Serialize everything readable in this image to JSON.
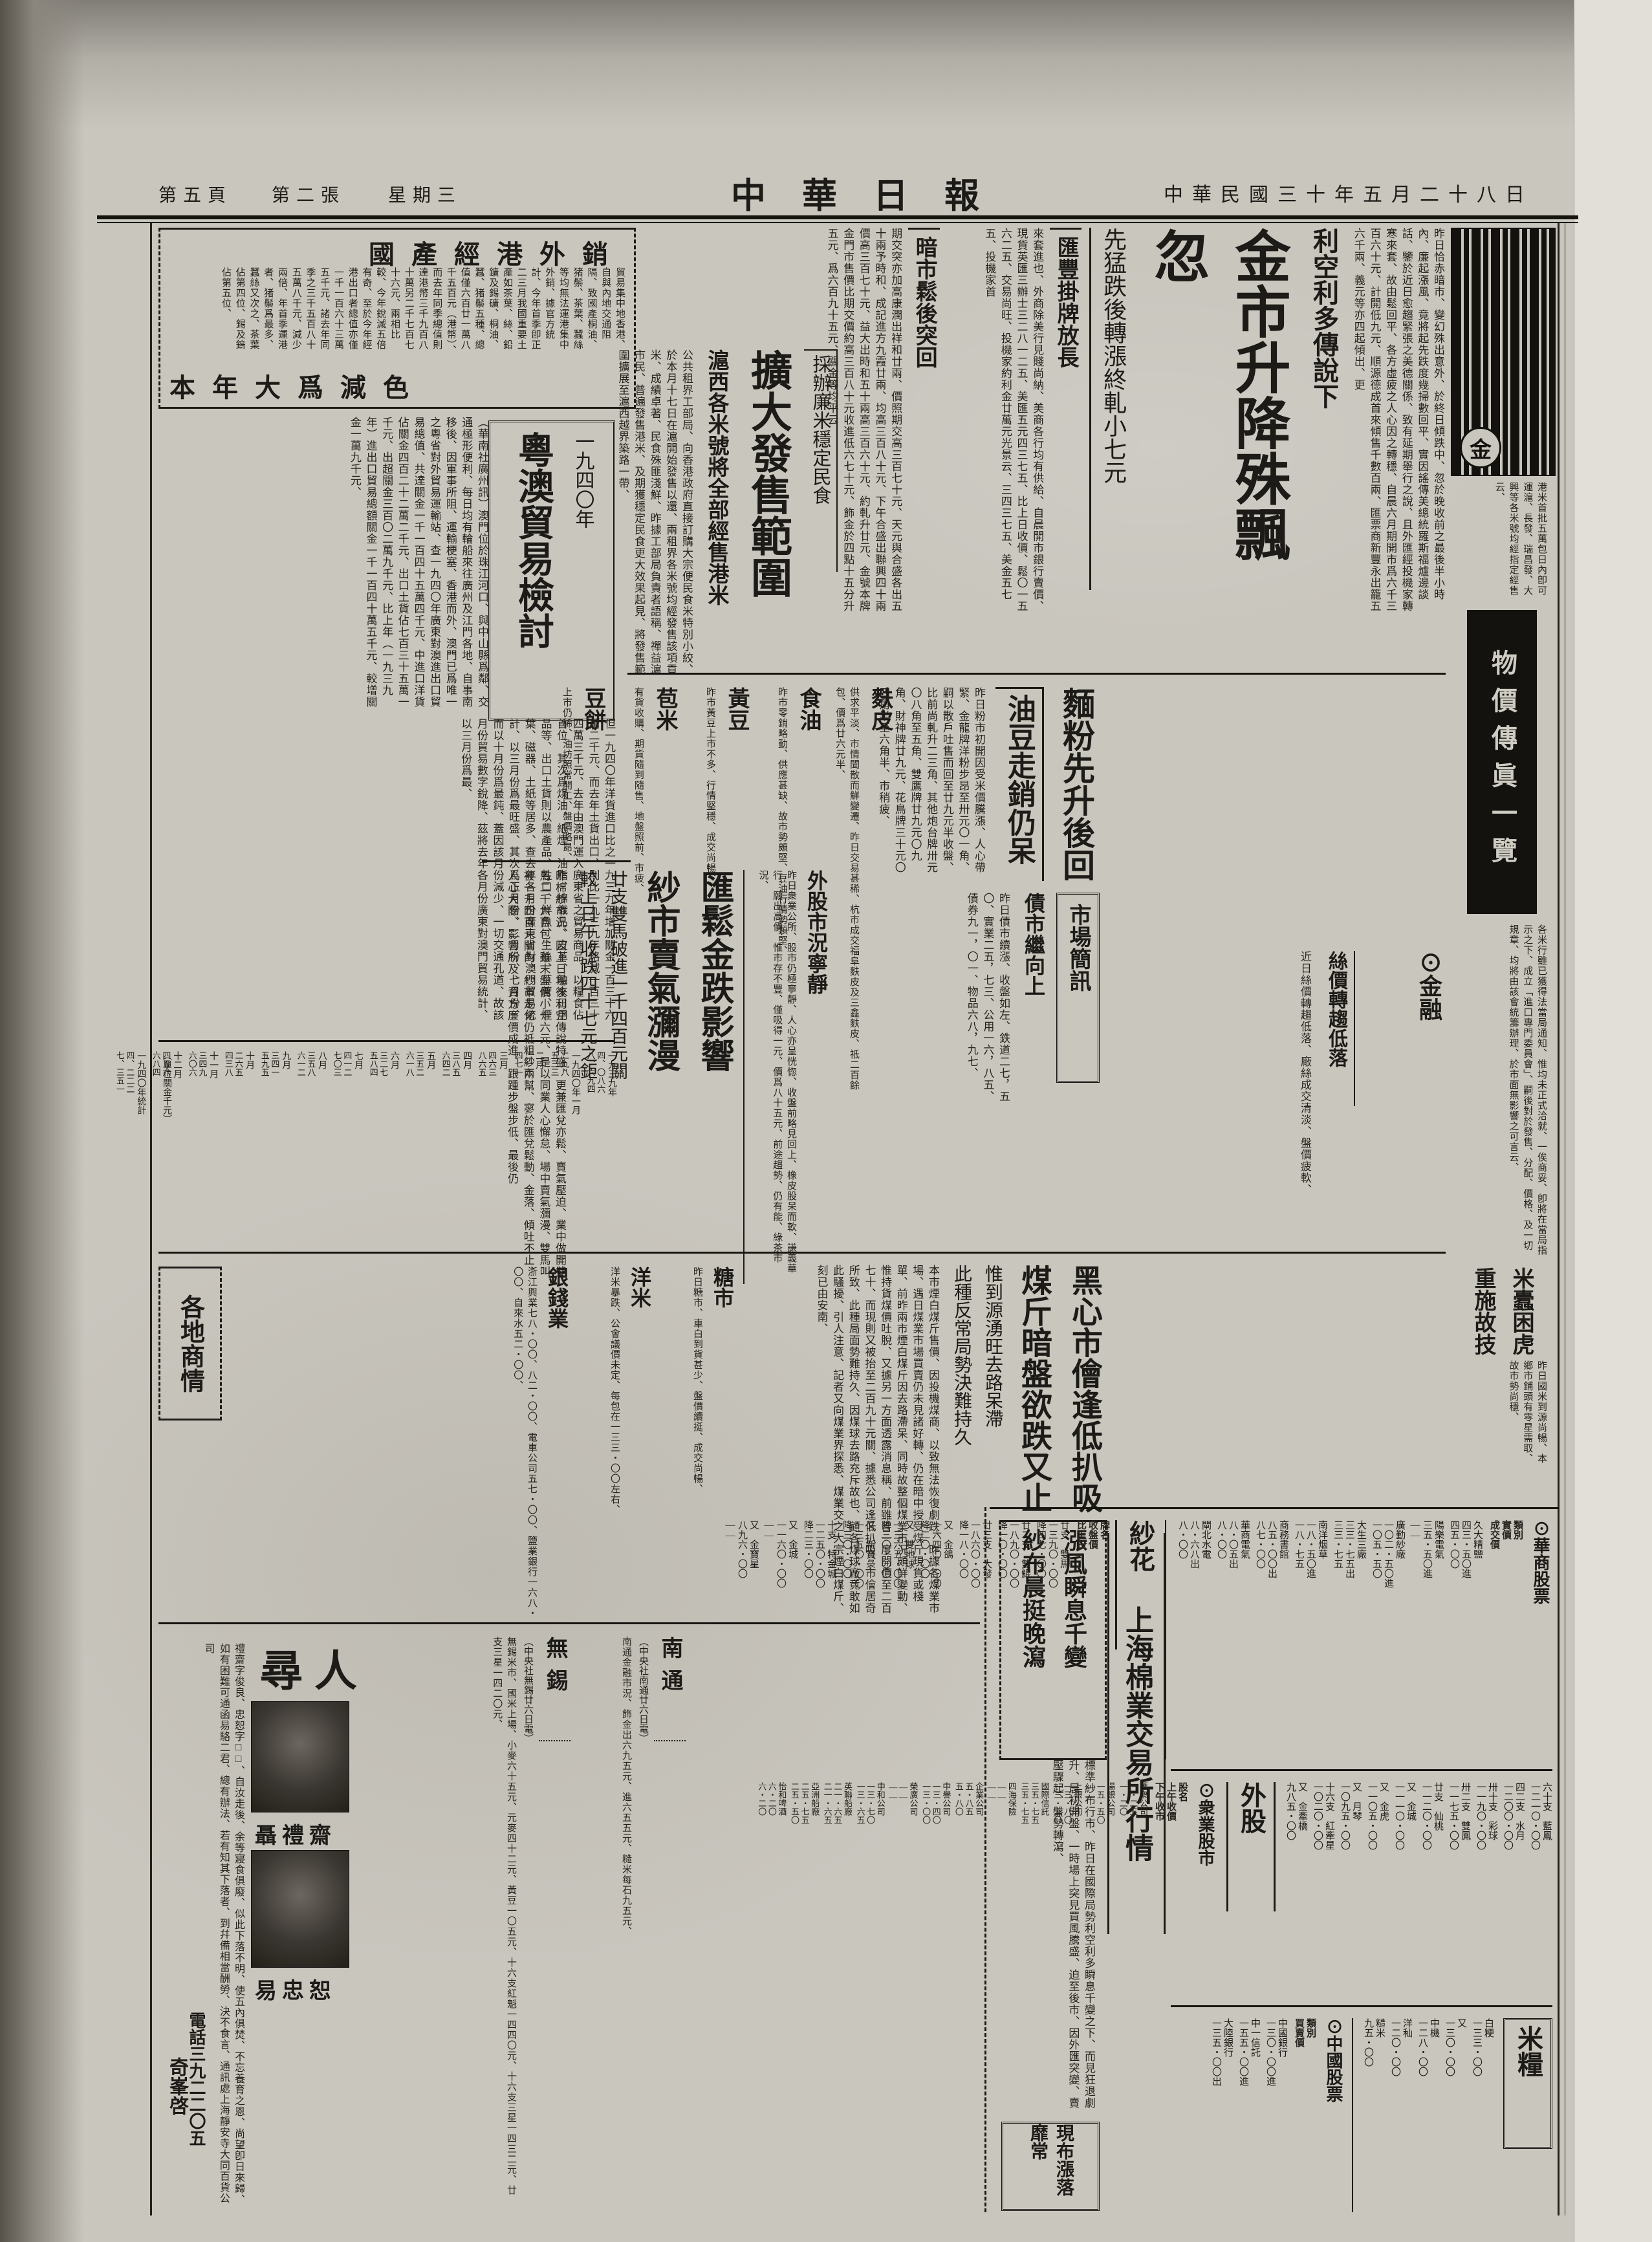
{
  "page": {
    "masthead": "中華日報",
    "dateline": "中華民國三十年五月二十八日",
    "weekday": "星期三",
    "sheet": "第二張",
    "page_no": "第五頁"
  },
  "lead": {
    "kicker": "利空利多傳說下",
    "headline": "金市升降殊飄忽",
    "subhead": "先猛跌後轉漲終軋小七元",
    "body1": "昨日恰赤暗市、變幻殊出意外、於終日傾跌中、忽於晚收前之最後半小時內、廉起漲風、竟將起先跌度幾掃數回平、實因謠傳美總統羅斯福爐邊談話、鑒於近日愈趨緊張之美德關係、致有延期舉行之說、且外匯經投機家轉寒來套、故由鬆回平、各方虛疲之人心因之轉穩、自晨六月期開市爲六千三百六十元、計開低九元、順源德成首來傾售千數百兩、匯票商新豐永出籠五六千兩、義元等亦四起傾出、更",
    "sub1": "匯豐掛牌放長",
    "body2": "來套進也、外商除美行見賤尚納、美商各行均有供給、自晨開市銀行賣價、現貨英匯三辦士三二八一二五、美匯五元四三七五、比上日收價、鬆〇一五六二五、交易尚旺、投機家約利金廿萬元光景云、三四三七五、美金五七五、投機家首",
    "sub2": "暗市鬆後突回",
    "body3": "期交突亦加高康潤出祥和廿兩、價照期交高三百七十元、天元與合盛各出五十兩予時和、成記進方九霞廿兩、均高三百八十元、下午合盛出聯興四十兩價高三百七十元、益大出時和五十兩高三百六十元、約軋升廿元、金號本牌金門市售價比期交價約高三百八十元收進低六七十元、飾金於四點十五分升五元、爲六百九十五元、關金等均平云"
  },
  "export_box": {
    "title_top": "國產經港外銷",
    "title_bottom": "本年大爲減色",
    "body": "貿易集中地香港、自與內地交通阻隔、致國產桐油、猪鬃、茶葉、蠶絲等均無法運港集中外銷、據官方統計、今年首季卽正二三月我國重要土產如茶葉、絲、鉛鑛及錫礦、桐油、蠶、猪鬃五種、總值僅六百廿一萬八千五百元（港幣）、而去年同季總值則達港幣三千九百八十萬另二千七百七十六元、兩相比較、今年銳減五倍有奇、至於今年經港出口者總值亦僅一千一百六十三萬五千元、諸去年同季之三千五百八十五萬八千元、減少兩倍、年首季運港者、猪鬃爲最多、蠶絲又次之、茶葉佔第四位、錫及鎢佔第五位、"
  },
  "yueao": {
    "kicker": "一九四〇年",
    "headline": "粵澳貿易檢討",
    "body1": "（華南社廣州訊）澳門位於珠江河口、與中山縣爲鄰、交通極形便利、每日均有輪船來往廣州及江門各地、自事南移後、因軍事所阻、運輸梗塞、香港而外、澳門已爲唯一之粵省對外貿易運輸站、查一九四〇年廣東對澳進出口貿易總值、共達關金一千一百四十五萬四千元、中進口洋貨佔關金四百二十二萬二千元、出口土貨佔七百三十五萬一千元、出超關金三百〇二萬九千元、比上年（一九三九年）進出口貿易總額關金一千一百四十萬五千元、較增關金一萬九千元、",
    "body2": "但一九四〇年洋貨進口比之一九三九年增加關金一百三十六萬二千元、而去年土貨出口、則比一九三九年略減一百三十四萬三千元、去年由澳門運入廣東省之貿易商品、以糧食佔首位、其次爲煤油、紙煙、油脂、棉織品、皮革、舶來日用品等、出口土貨則以農產品、牲口、鮮魚、生絲、草蓆、煙葉、磁器、土紙等居多、查去年各月份廣東省對澳門貿易統計、以三月份爲最旺盛、其次爲正月份、二月份、七月份、而以十月份爲最鈍、蓋因該月份減少、一切交通孔道、故該月份貿易數字銳降、茲將去年各月份廣東對澳門貿易統計、以三月份爲最、",
    "table_note": "（單位關金千元）",
    "col_in": "進",
    "col_out": "出",
    "months": [
      {
        "m": "一九三九年",
        "i": "四、〇八六",
        "o": "八、六九四"
      },
      {
        "m": "一九四〇年一月",
        "i": "二九八",
        "o": "五三三"
      },
      {
        "m": "二月",
        "i": "二一六",
        "o": "四七一"
      },
      {
        "m": "三月",
        "i": "四六三",
        "o": "八六五"
      },
      {
        "m": "四月",
        "i": "三八五",
        "o": "六四二"
      },
      {
        "m": "五月",
        "i": "三五二",
        "o": "六一八"
      },
      {
        "m": "六月",
        "i": "三二七",
        "o": "五八四"
      },
      {
        "m": "七月",
        "i": "四一二",
        "o": "七〇三"
      },
      {
        "m": "八月",
        "i": "三五八",
        "o": "六一二"
      },
      {
        "m": "九月",
        "i": "三四一",
        "o": "五九五"
      },
      {
        "m": "十月",
        "i": "二六五",
        "o": "四三八"
      },
      {
        "m": "十一月",
        "i": "三四九",
        "o": "六〇六"
      },
      {
        "m": "十二月",
        "i": "四五六",
        "o": "六八四"
      },
      {
        "m": "一九四〇年統計",
        "i": "四、二二二",
        "o": "七、三五一"
      }
    ]
  },
  "rice": {
    "kicker": "採辦廉米穩定民食",
    "headline": "擴大發售範圍",
    "subhead": "滬西各米號將全部經售港米",
    "body": "公共租界工部局、向香港政府直接訂購大宗便民食米特別小絞、於本月十七日在滬開始發售以還、兩租界各米號均經發售該項貢米、成績卓著、民食殊匪淺鮮、昨據工部局負責者語稱、禪益滬市民、普遍發售港米、及期獲穩定民食更大效果起見、將發售範圍擴展至滬西越界築路一帶、"
  },
  "flour": {
    "headline": "麵粉先升後回",
    "headline2": "油豆走銷仍呆",
    "body": "昨日粉市初開因受米價騰漲、人心帶緊、金龍牌洋粉步昂至卅元〇一角、嗣以散戶吐售而回至廿九元半收盤、比前尚軋升二三角、其他炮台牌卅元〇八角至五角、雙鷹牌廿九元〇九角、財神牌廿九元、花鳥牌三十元〇四角半至六角半、市稍疲、"
  },
  "bond": {
    "headline": "債市繼向上",
    "body": "昨日債市續漲、收盤如左、鉄道二七，五〇、實業二五，七三、公用一六，八五、債券九一，〇一、物品六八，九七、"
  },
  "brief_label": "市場簡訊",
  "commodities": [
    {
      "name": "麩皮",
      "body": "供求平淡、市情聞散而鮮變遷、昨日交易甚稀、杭市成交福阜麩皮及三鑫麩皮、祗二百餘包、價爲廿六元半、"
    },
    {
      "name": "食油",
      "body": "昨市零銷略動、供應甚缺、故市勢頗堅、豆油行情勢類堅、"
    },
    {
      "name": "黃豆",
      "body": "昨市黃豆上市不多、行情堅穩、成交尚暢、"
    },
    {
      "name": "苞米",
      "body": "有貨收購、期貨隨到隨售、地盤照前、市疲、"
    },
    {
      "name": "豆餅",
      "body": "上市仍稀、油坊照常開工、盤價略昂、"
    }
  ],
  "yarn": {
    "headline": "匯鬆金跌影響",
    "headline2": "紗市賣氣瀰漫",
    "subhead": "廿支雙馬破進一千四百元關",
    "subhead2": "較上日午收跌四十七元之鉅",
    "body": "昨棉紗市況、因上日場後利空傳說特盛、更兼匯兌亦鬆、賣氣壓迫、業中做開雙馬二千六百包、雖末盤價小十六元、是以同業人心懈怠、場中賣氣瀰漫、雙馬叫被一千四百元關內、紗市走化仍祗粗紗兩幫、寥於匯兌鬆動、金落、傾吐不止、人心大際、影響所及、資方廉價成進、跟踵步盤步低、最後仍"
  },
  "stocks": {
    "headline": "外股市況寧靜",
    "body": "昨日衆業公所、股市仍極寧靜、人心亦呈恍惚、收盤前略見回上、橡皮股呆而軟、謙義華行、願出高價、惟市存不豐、僅吸得一元、價爲八十五元、前途趨勢、仍有能、綠茶市況、"
  },
  "finance": {
    "title": "⊙金融",
    "quotes": [
      "標金每條　六三六〇・〇〇",
      "比上日　　低九・〇〇",
      "飾金每兩　六九五・〇〇",
      "比上日　　升五・〇〇",
      "英匯　三辦士三二八一二五",
      "美匯　五・四三七五　升〇・〇二",
      "關金　平　　交易尚旺"
    ],
    "silk_head": "絲價轉趨低落",
    "silk_body": "近日絲價轉趨低落、廠絲成交清淡、盤價疲軟、"
  },
  "coal": {
    "headline": "黑心市儈逢低扒吸",
    "headline2": "煤斤暗盤欲跌又止",
    "kicker": "惟到源湧旺去路呆滯",
    "kicker2": "此種反常局勢決難持久",
    "body": "本市煙白煤斤售價、因投機煤商、以致無法恢復劇跌、昨據各煤業市場、遇日煤業市場買賣仍未見諸好轉、仍在暗中授受煤斤現貨或棧單、前昨兩市煙白煤斤因去路滯呆、同時故整個煤業市況頗鮮變動、惟持貨煤價吐脫、又據另一方面透露消息稱、前雖曾一度開價至二百七十、而現則又被抬至二百九十元關、據悉公司逢低扒吸、市儈居奇所致、此種局面勢難持久、因煤球去路充斥故也、顧各煤球廠竟敢如此騷擾、引人注意、記者又向煤業界探悉、煤業交之大宗煙白煤斤、刻已由安南、"
  },
  "regional": {
    "box_label": "各地商情",
    "sections": [
      {
        "name": "糖市",
        "body": "昨日糖市、車白到貨甚少、盤價續挺、成交尚暢、"
      },
      {
        "name": "洋米",
        "body": "洋米暴跌、公會議價未定、每包在一三三・〇〇左右、"
      },
      {
        "name": "銀錢業",
        "body": "浙江興業七八・〇〇、八二・〇〇、電車公司五七・〇〇、鹽業銀行一六八・〇〇、自來水五二・〇〇、"
      }
    ],
    "wires": [
      {
        "name": "南通",
        "byline": "（中央社南通廿六日電）",
        "body": "南通金融市況、飾金出六九五元、進六五五元、糙米每石九五元、"
      },
      {
        "name": "無錫",
        "byline": "（中央社無錫廿六日電）",
        "body": "無錫米市、國米上場、小麥六十五元、元麥四十二元、黃豆一〇五元、十六支紅魁一四四〇元、十六支三星一四三二元、廿支三星一四二〇元、"
      }
    ]
  },
  "missing": {
    "title": "尋人",
    "name1": "聶禮齋",
    "name2": "易忠恕",
    "body": "禮齋字俊良、忠恕字□□、自汝走後、余等寢食俱廢、似此下落不明、使五內俱焚、不忘養育之恩、尚望卽日來歸、如有困難可通函易駱二君、總有辦法、若有知其下落者、到幷備相當酬勞、決不食言、通訊處上海靜安寺大同百貨公司",
    "phone": "電話三九二二〇五",
    "signer": "奇峯啓"
  },
  "exchange": {
    "headline": "漲風瞬息千變",
    "headline2": "紗布晨挺晚瀉",
    "section_title": "上海棉業交易所行情",
    "body": "標準紗布行市、昨日在國際局勢利空利多瞬息千變之下、而見狂退劇升、晨初開盤、一時場上突見買風騰盛、迫至後市、因外匯突變、賣壓驟起、盤勢轉瀉、",
    "box2": "現布漲落靡常",
    "sha_hua_label": "紗花",
    "sha_hua_head": {
      "c1": "牌名",
      "c2": "收盤價",
      "c3": "比上日"
    },
    "sha_hua": [
      {
        "nm": "廿支　雙馬",
        "p1": "一三九〇・〇〇",
        "p2": "降四七・〇〇"
      },
      {
        "nm": "廿二支　雙鯤",
        "p1": "一八九〇・〇〇",
        "p2": "降一〇・〇〇"
      },
      {
        "nm": "廿三支　大發",
        "p1": "一八六〇・〇〇",
        "p2": "降一八・〇〇"
      },
      {
        "nm": "又　金鴿",
        "p1": "一六四〇・〇〇",
        "p2": "降二〇・〇〇"
      },
      {
        "nm": "又　雙地球",
        "p1": "一三六五・〇〇",
        "p2": "降三〇・〇〇"
      },
      {
        "nm": "又　新寶彔",
        "p1": "一三五〇・〇〇",
        "p2": "降三〇・〇〇"
      },
      {
        "nm": "十支　特金城",
        "p1": "一二五〇・〇〇",
        "p2": "降二三・〇〇"
      },
      {
        "nm": "又　金城",
        "p1": "一一六〇・〇〇",
        "p2": "——"
      },
      {
        "nm": "又　金寶星",
        "p1": "八九六・〇〇",
        "p2": "——"
      }
    ],
    "hua_shang_title": "⊙華商股票",
    "hua_shang_head": {
      "c1": "類別",
      "c2": "實價",
      "c3": "成交價"
    },
    "hua_shang": [
      {
        "nm": "久大精鹽",
        "p1": "四三・五〇進",
        "p2": "四五・〇〇"
      },
      {
        "nm": "陽樂電氣",
        "p1": "三五・五〇進",
        "p2": "——"
      },
      {
        "nm": "廣勤紗廠",
        "p1": "一〇二・五〇進",
        "p2": "一〇五・五〇"
      },
      {
        "nm": "大生三廠",
        "p1": "三三・七五出",
        "p2": "三三・七五"
      },
      {
        "nm": "南洋烟草",
        "p1": "一八・五〇進",
        "p2": "一八・七五"
      },
      {
        "nm": "商務書館",
        "p1": "八五・〇〇出",
        "p2": "八七・〇〇"
      },
      {
        "nm": "華商電氣",
        "p1": "八・〇五出",
        "p2": "八・〇〇"
      },
      {
        "nm": "閘北水電",
        "p1": "八・六八出",
        "p2": "八・〇〇"
      }
    ],
    "zhong_ye_title": "⊙衆業股市",
    "zhong_ye_head": {
      "c1": "股名",
      "c2": "上午收價",
      "c3": "下午收市"
    },
    "zhong_ye": [
      {
        "nm": "匯衆公司",
        "p1": "一・二五",
        "p2": "一・二〇"
      },
      {
        "nm": "湯銀公司",
        "p1": "一五・五〇",
        "p2": "——"
      },
      {
        "nm": "上銀公司",
        "p1": "一三・八〇",
        "p2": "一三・五〇"
      },
      {
        "nm": "國際信託",
        "p1": "三五・七五",
        "p2": "三五・七五"
      },
      {
        "nm": "四海保險",
        "p1": "——",
        "p2": "——"
      },
      {
        "nm": "企業公司",
        "p1": "五・八五",
        "p2": "五・八〇"
      },
      {
        "nm": "中譽公司",
        "p1": "一三・四〇",
        "p2": "一三・〇〇"
      },
      {
        "nm": "榮廣公司",
        "p1": "——",
        "p2": "——"
      },
      {
        "nm": "中和公司",
        "p1": "一三・七〇",
        "p2": "一三・六五"
      },
      {
        "nm": "英聯船廠",
        "p1": "二一・六五",
        "p2": "二一・六五"
      },
      {
        "nm": "亞洲船廠",
        "p1": "二五・七五",
        "p2": "二五・五〇"
      },
      {
        "nm": "怡和啤酒",
        "p1": "六・二〇",
        "p2": "六・二〇"
      }
    ],
    "wai_gu_label": "外股",
    "wai_gu": [
      {
        "nm": "六十支　藍鳳",
        "p1": "一二一〇・〇〇"
      },
      {
        "nm": "四二支　水月",
        "p1": "一二〇〇・〇〇"
      },
      {
        "nm": "卅十支　彩球",
        "p1": "一一九〇・〇〇"
      },
      {
        "nm": "卅二支　雙鳳",
        "p1": "一一七五・〇〇"
      },
      {
        "nm": "廿支　仙桃",
        "p1": "一一二〇・〇〇"
      },
      {
        "nm": "又　金城",
        "p1": "一一一〇・〇〇"
      },
      {
        "nm": "又　金虎",
        "p1": "一一〇五・〇〇"
      },
      {
        "nm": "又　月琴",
        "p1": "一〇九五・〇〇"
      },
      {
        "nm": "十六支　紅牽星",
        "p1": "一〇二〇・〇〇"
      },
      {
        "nm": "又　金牽橋",
        "p1": "九八五・〇〇"
      }
    ],
    "zhong_guo_title": "⊙中國股票",
    "zhong_guo_head": {
      "c1": "類別",
      "c2": "買賣價"
    },
    "zhong_guo": [
      {
        "nm": "中國銀行",
        "p1": "一三〇・〇〇進"
      },
      {
        "nm": "中一信託",
        "p1": "一五五・〇〇進"
      },
      {
        "nm": "大陸銀行",
        "p1": "一三五・〇〇出"
      }
    ],
    "mi_liang_label": "米糧",
    "mi_liang": [
      {
        "nm": "白粳",
        "p1": "一三三・〇〇"
      },
      {
        "nm": "又",
        "p1": "一三〇・〇〇"
      },
      {
        "nm": "中機",
        "p1": "一二八・〇〇"
      },
      {
        "nm": "洋秈",
        "p1": "一二〇・〇〇"
      },
      {
        "nm": "糙米",
        "p1": "九五・〇〇"
      }
    ]
  },
  "rail": {
    "snippet": "港米首批五萬包日內卽可運滬、長發、瑞昌發、大興等各米號均經指定經售云、",
    "banner": "物價傳眞一覽",
    "body": "各米行雖已獲得法當局通知、惟均未正式洽就、一俟商妥、卽將在當局指示之下、成立「進口專門委員會」、嗣後對於發售、分配、價格、及一切規章、均將由該會統籌辦理、於市面無影響之可言云、",
    "sub1": "米蠹困虎",
    "sub2": "重施故技",
    "tail": "昨日國米到源尚暢、本鄉市鋪頭有零星需取、故市勢尚穩、"
  },
  "grain_quotes": [
    "白粳　一三三・〇〇",
    "又　　一三〇・〇〇",
    "中機　一二八・〇〇",
    "洋秈　一二〇・〇〇",
    "糙米　九五・〇〇",
    "小麥　六五・〇〇",
    "元麥　四二・〇〇",
    "黃豆　一〇五・〇〇",
    "麵粉　二九・五〇",
    "洋粉　三〇・一〇"
  ],
  "logo_seal": "金"
}
